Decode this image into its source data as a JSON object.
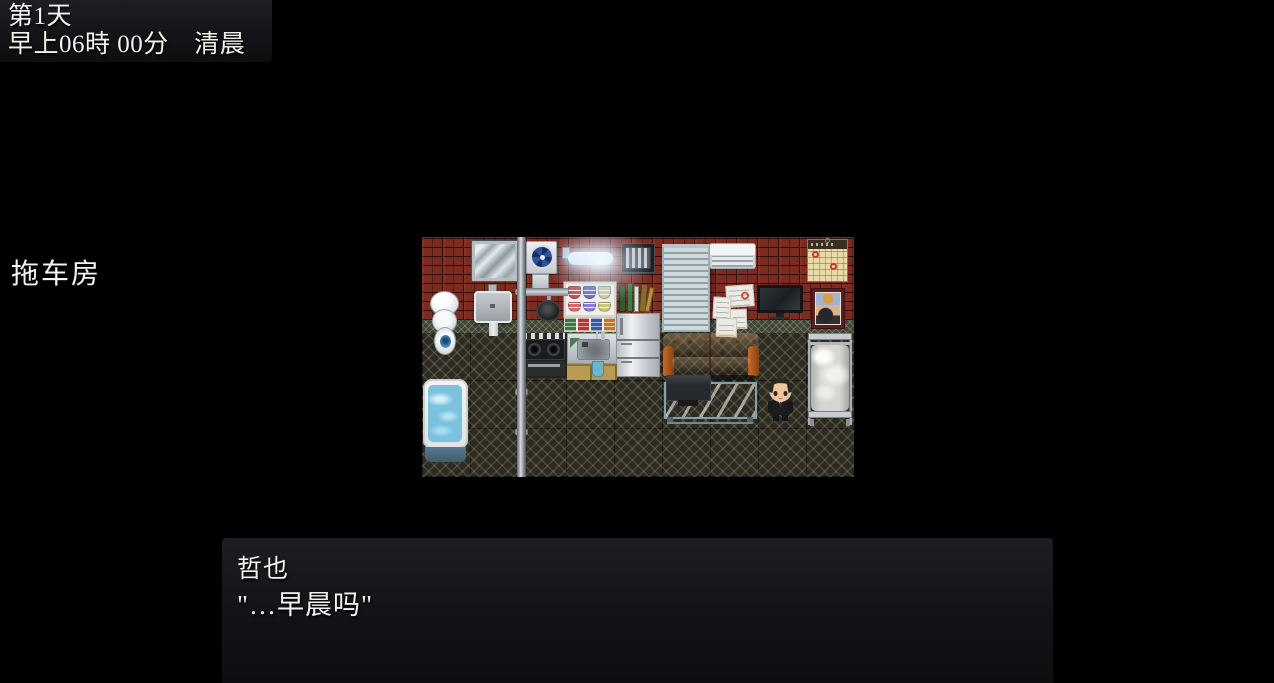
{
  "screen": {
    "background_color": "#000000"
  },
  "time_window": {
    "day": "第1天",
    "time": "早上06時 00分　清晨"
  },
  "location_label": "拖车房",
  "dialog_window": {
    "speaker": "哲也",
    "text": "\"…早晨吗\""
  },
  "map_scene": {
    "name": "trailer-house-interior",
    "items": [
      "mirror",
      "ventilation-fan",
      "fluorescent-light",
      "air-vent",
      "window-blinds",
      "air-conditioner",
      "wall-calendar",
      "toilet",
      "wall-sink",
      "water-pipe",
      "hanging-frying-pan",
      "dish-shelf",
      "towel-shelf",
      "book-stack",
      "refrigerator",
      "gas-stove",
      "kitchen-sink",
      "kitchen-counter",
      "hand-towel",
      "wall-notes",
      "wall-tv",
      "poster",
      "leather-sofa",
      "glass-table",
      "laptop",
      "bathtub",
      "metal-bed",
      "player-character"
    ],
    "colors": {
      "brick_wall": "#7c2b20",
      "floor": "#2c2a21",
      "sofa": "#c2631f",
      "bath_water": "#7cc2de",
      "glass_table": "#bcd9e2",
      "bedding": "#d6d6d0"
    }
  }
}
